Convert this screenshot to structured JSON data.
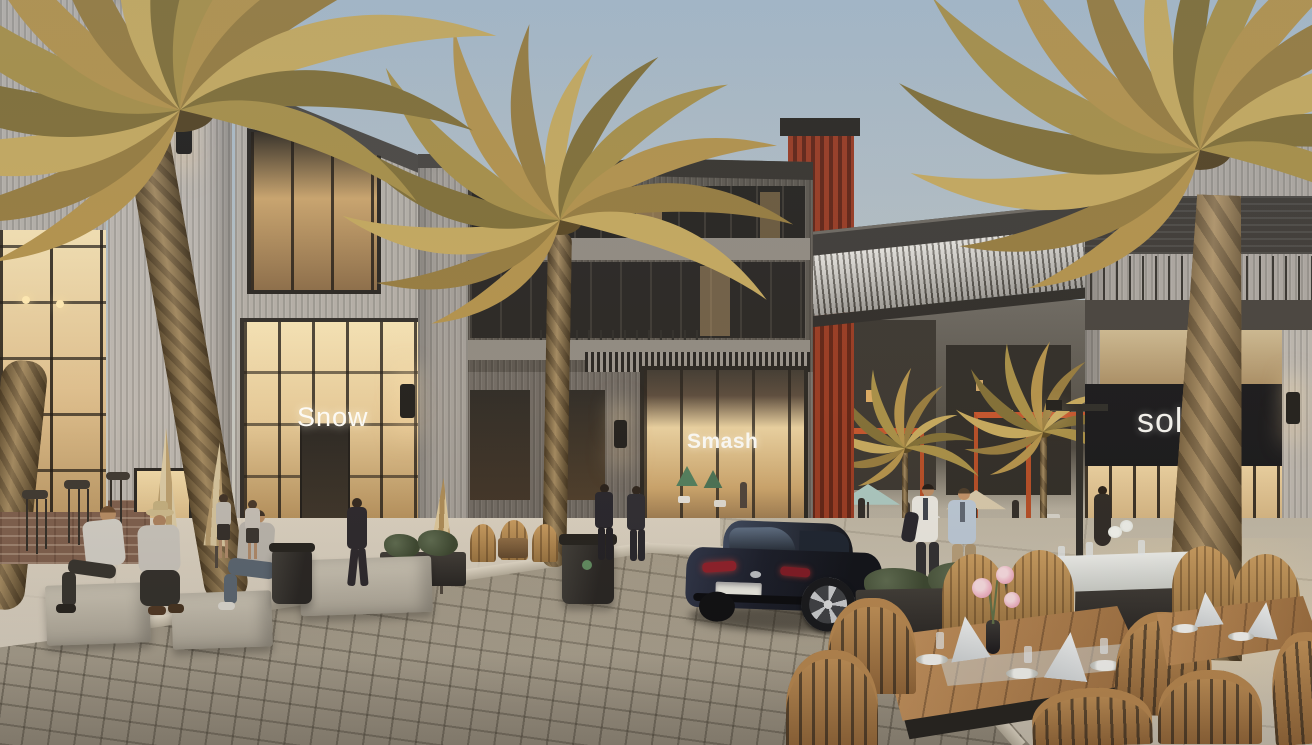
{
  "scene": {
    "description": "Architectural rendering of a modern open-air retail plaza at dusk: palm trees, cobblestone street, outdoor dining tables, pedestrians and a dark parked sedan between storefronts",
    "time_of_day": "dusk",
    "storefront_signs": {
      "left": "Snow",
      "center": "Smash",
      "right": "sola"
    },
    "car": {
      "type": "sedan",
      "badge_icon": "mazda-winged-m-badge",
      "body_color": "#161b28"
    },
    "palette": {
      "sky_top": "#a4b7c7",
      "sky_horizon": "#dad3c5",
      "facade_light": "#b7b2ac",
      "facade_dark": "#57524b",
      "accent_rust": "#93351e",
      "window_glow": "#eecf9d",
      "cobblestone": "#948c7c",
      "pavement": "#cbc4b4",
      "palm_gold": "#b3944e",
      "wood": "#b98952",
      "canopy_orange": "#c2512a",
      "napkin_white": "#f0f2f3"
    }
  }
}
